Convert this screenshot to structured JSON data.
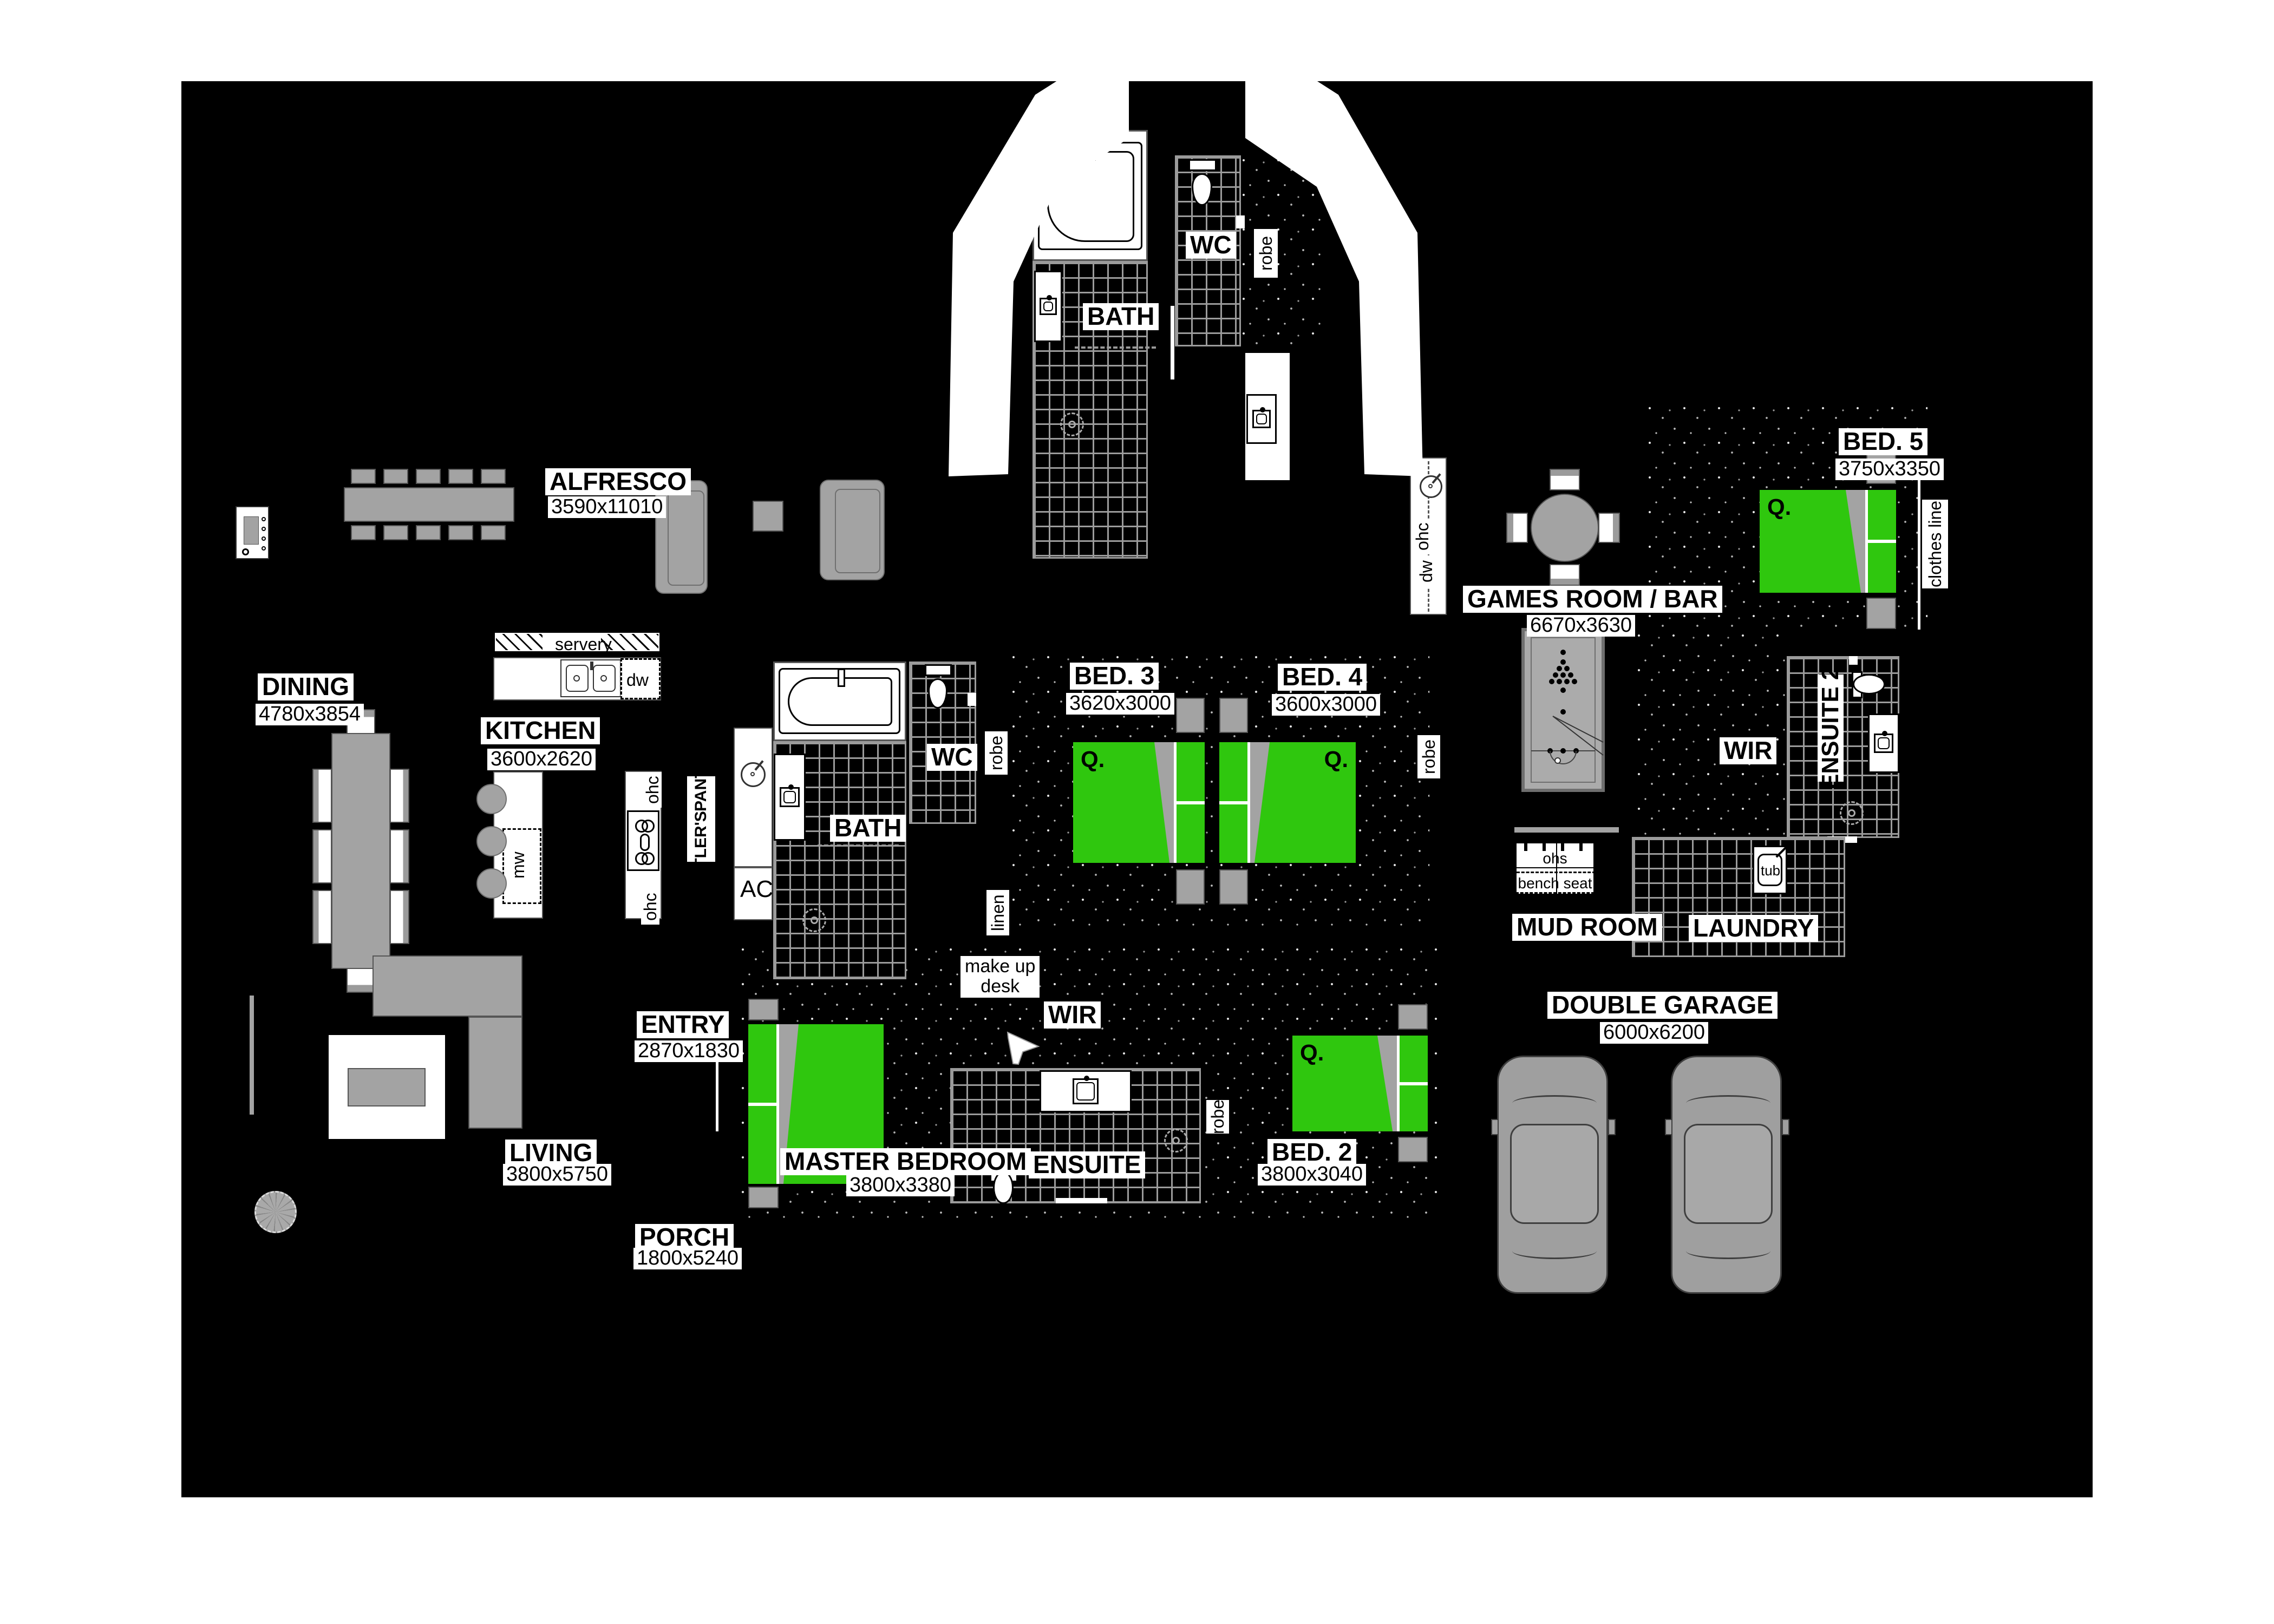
{
  "plan_title": "floor plan",
  "colors": {
    "page": "#ffffff",
    "floor": "#000000",
    "bed_green": "#2fc70e",
    "furniture_gray": "#a3a3a3",
    "tile_line": "#9b9b9b",
    "label_bg": "#ffffff",
    "label_text": "#000000"
  },
  "labels": {
    "alfresco": {
      "name": "ALFRESCO",
      "dims": "3590x11010"
    },
    "dining": {
      "name": "DINING",
      "dims": "4780x3854"
    },
    "kitchen": {
      "name": "KITCHEN",
      "dims": "3600x2620"
    },
    "bath_top": {
      "name": "BATH"
    },
    "wc_top": {
      "name": "WC"
    },
    "bath_mid": {
      "name": "BATH"
    },
    "wc_mid": {
      "name": "WC"
    },
    "bed3": {
      "name": "BED. 3",
      "dims": "3620x3000"
    },
    "bed4": {
      "name": "BED. 4",
      "dims": "3600x3000"
    },
    "bed5": {
      "name": "BED. 5",
      "dims": "3750x3350"
    },
    "games": {
      "name": "GAMES ROOM / BAR",
      "dims": "6670x3630"
    },
    "ensuite2": {
      "name": "ENSUITE 2"
    },
    "wir": {
      "name": "WIR"
    },
    "wir_m": {
      "name": "WIR"
    },
    "mudroom": {
      "name": "MUD ROOM"
    },
    "laundry": {
      "name": "LAUNDRY"
    },
    "garage": {
      "name": "DOUBLE GARAGE",
      "dims": "6000x6200"
    },
    "entry": {
      "name": "ENTRY",
      "dims": "2870x1830"
    },
    "living": {
      "name": "LIVING",
      "dims": "3800x5750"
    },
    "porch": {
      "name": "PORCH",
      "dims": "1800x5240"
    },
    "master": {
      "name": "MASTER BEDROOM",
      "dims": "3800x3380"
    },
    "ensuite_m": {
      "name": "ENSUITE"
    },
    "bed2": {
      "name": "BED. 2",
      "dims": "3800x3040"
    },
    "make_up": {
      "name": "make up",
      "line2": "desk"
    }
  },
  "small": {
    "robe": "robe",
    "linen": "linen",
    "clothes_line": "clothes line",
    "servery": "servery",
    "dw": "dw",
    "ohc": "ohc",
    "mw": "mw",
    "ac": "AC",
    "butlers1": "BUTLER'S",
    "butlers2": "PANTRY",
    "ohs": "ohs",
    "bench_seat": "bench seat",
    "tub": "tub",
    "queen": "Q.",
    "king": "K."
  }
}
